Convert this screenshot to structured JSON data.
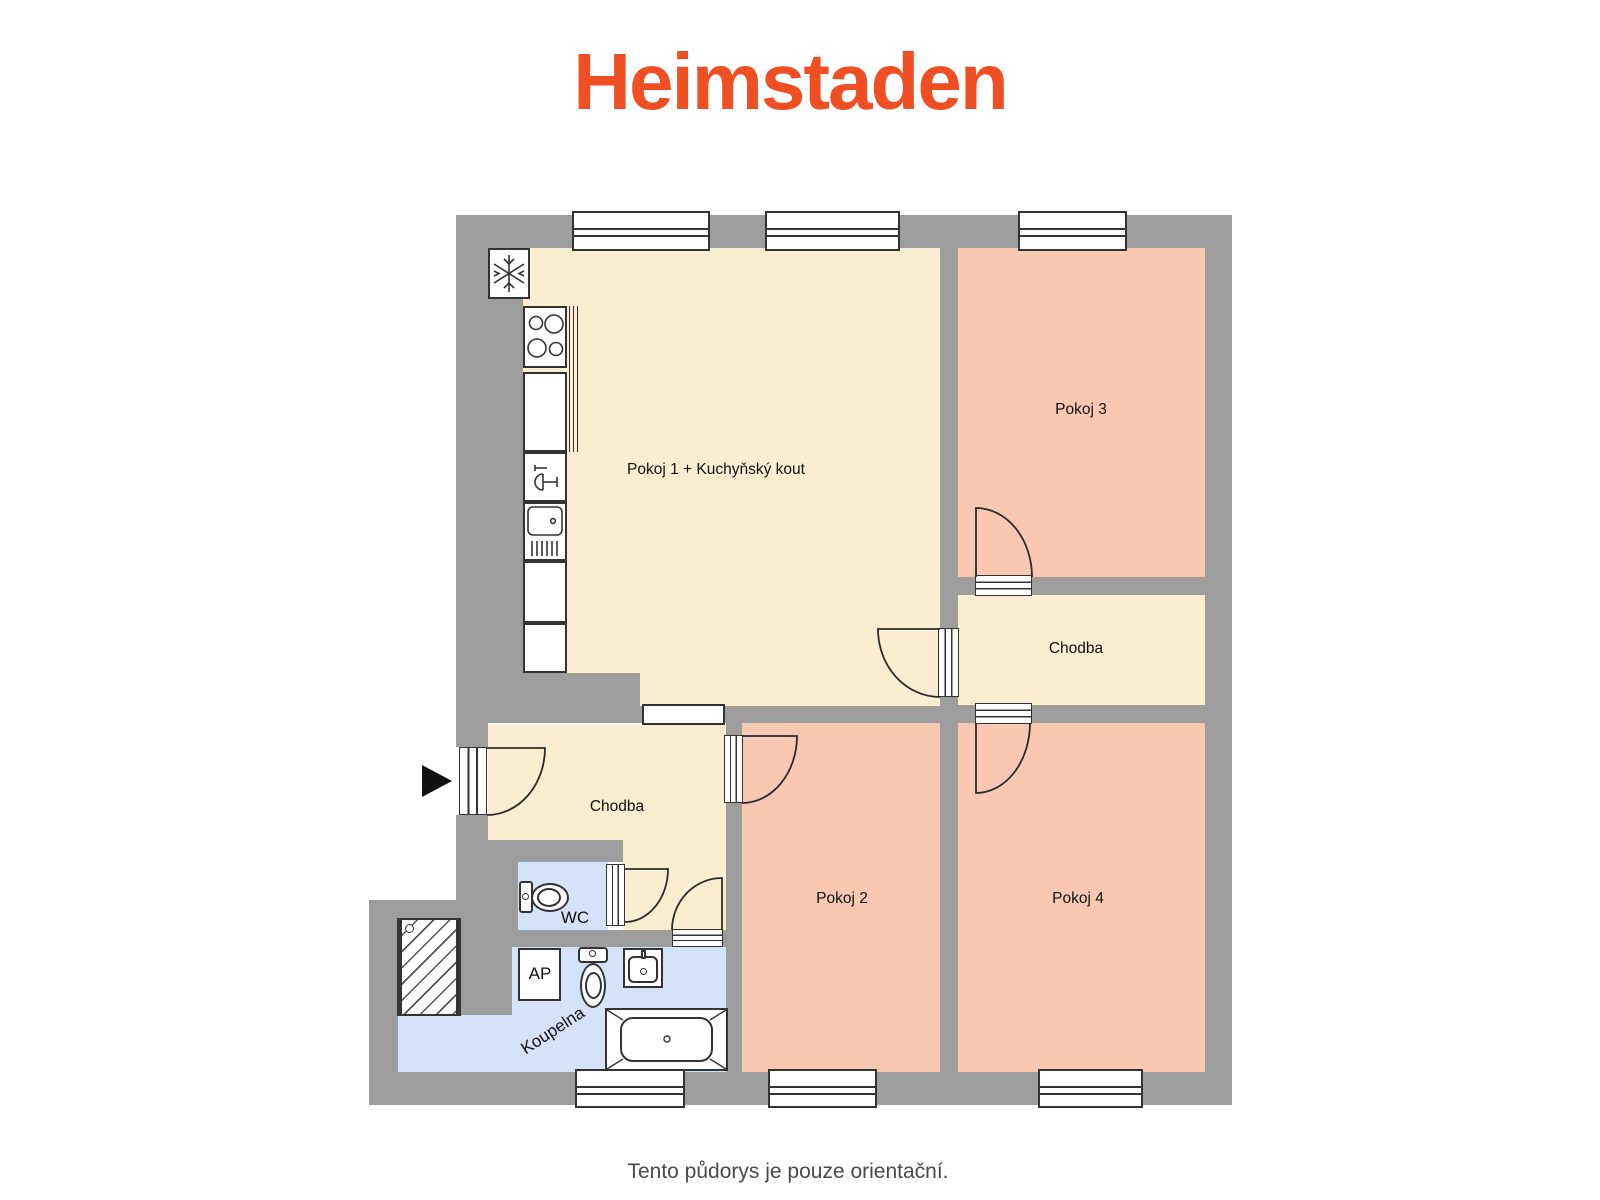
{
  "brand": {
    "logo_text": "Heimstaden",
    "logo_color": "#F04E23"
  },
  "footer": {
    "disclaimer": "Tento půdorys je pouze orientační."
  },
  "floor_plan": {
    "colors": {
      "wall": "#9D9D9D",
      "room_warm": "#FBEDD1",
      "room_pink": "#F8C9B0",
      "room_blue": "#D4E3F8",
      "outline": "#333333"
    },
    "rooms": [
      {
        "id": "pokoj1",
        "label": "Pokoj 1 + Kuchyňský kout",
        "color": "#FBEDD1"
      },
      {
        "id": "pokoj2",
        "label": "Pokoj 2",
        "color": "#F8C9B0"
      },
      {
        "id": "pokoj3",
        "label": "Pokoj 3",
        "color": "#F8C9B0"
      },
      {
        "id": "pokoj4",
        "label": "Pokoj 4",
        "color": "#F8C9B0"
      },
      {
        "id": "chodba-right",
        "label": "Chodba",
        "color": "#FBEDD1"
      },
      {
        "id": "chodba-left",
        "label": "Chodba",
        "color": "#FBEDD1"
      },
      {
        "id": "wc",
        "label": "WC",
        "color": "#D4E3F8"
      },
      {
        "id": "koupelna",
        "label": "Koupelna",
        "color": "#D4E3F8"
      }
    ],
    "fixtures": {
      "washing_machine_label": "AP",
      "fridge_icon": "snowflake",
      "stove_icon": "four-burner-cooktop",
      "kitchen_sink_icon": "sink-with-drainboard",
      "kitchen_tap_icon": "tap",
      "wc_toilet_icon": "toilet",
      "bathroom_toilet_icon": "toilet",
      "bathroom_sink_icon": "washbasin",
      "bathtub_icon": "bathtub",
      "shaft_icon": "hatched-light-shaft",
      "entry_icon": "right-pointing-arrow"
    }
  }
}
